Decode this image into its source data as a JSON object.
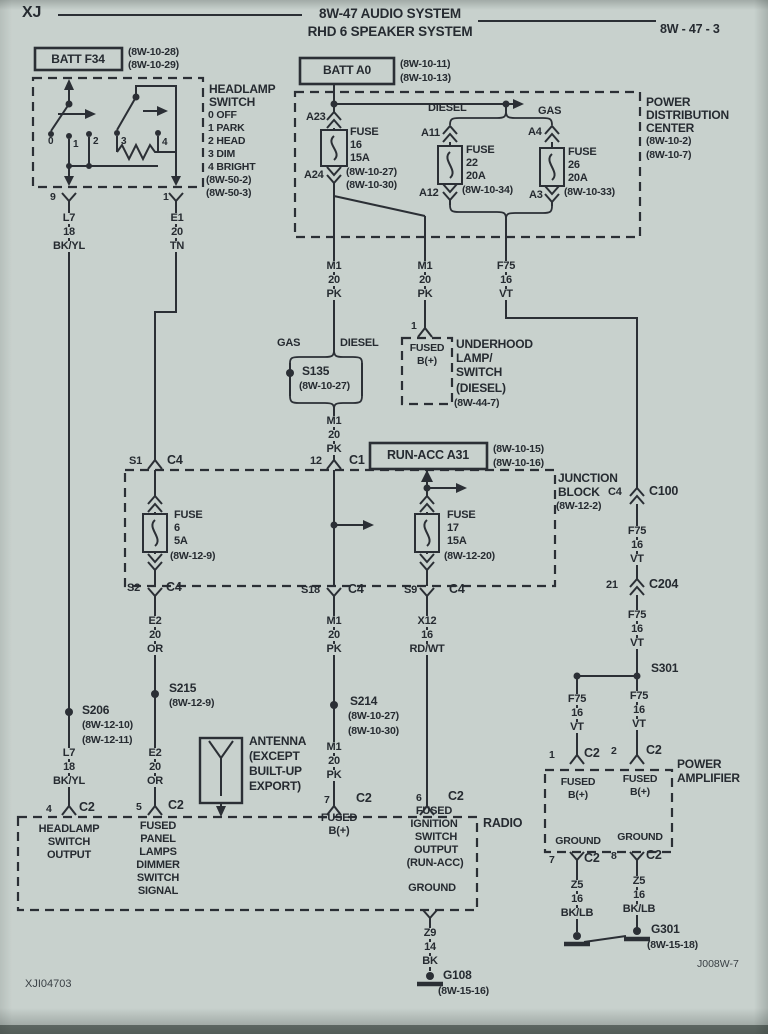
{
  "page": {
    "model": "XJ",
    "title1": "8W-47 AUDIO SYSTEM",
    "title2": "RHD 6 SPEAKER SYSTEM",
    "page_ref": "8W - 47 - 3",
    "footer_left": "XJI04703",
    "footer_right": "J008W-7"
  },
  "colors": {
    "paper": "#c8d1cd",
    "ink": "#2b2f35"
  },
  "labels": [
    {
      "t": "BATT F34",
      "x": 78,
      "y": 53,
      "a": "c",
      "s": 12
    },
    {
      "t": "(8W-10-28)",
      "x": 128,
      "y": 47,
      "s": 10.5
    },
    {
      "t": "(8W-10-29)",
      "x": 128,
      "y": 60,
      "s": 10.5
    },
    {
      "t": "HEADLAMP",
      "x": 209,
      "y": 83,
      "s": 12
    },
    {
      "t": "SWITCH",
      "x": 209,
      "y": 96,
      "s": 12
    },
    {
      "t": "0 OFF",
      "x": 208,
      "y": 110,
      "s": 10.5
    },
    {
      "t": "1 PARK",
      "x": 208,
      "y": 123,
      "s": 10.5
    },
    {
      "t": "2 HEAD",
      "x": 208,
      "y": 136,
      "s": 10.5
    },
    {
      "t": "3 DIM",
      "x": 208,
      "y": 149,
      "s": 10.5
    },
    {
      "t": "4 BRIGHT",
      "x": 208,
      "y": 162,
      "s": 10.5
    },
    {
      "t": "(8W-50-2)",
      "x": 206,
      "y": 175,
      "s": 10.5
    },
    {
      "t": "(8W-50-3)",
      "x": 206,
      "y": 188,
      "s": 10.5
    },
    {
      "t": "0",
      "x": 48,
      "y": 137,
      "s": 10
    },
    {
      "t": "1",
      "x": 73,
      "y": 140,
      "s": 10
    },
    {
      "t": "2",
      "x": 93,
      "y": 137,
      "s": 10
    },
    {
      "t": "3",
      "x": 121,
      "y": 137,
      "s": 10
    },
    {
      "t": "4",
      "x": 162,
      "y": 138,
      "s": 10
    },
    {
      "t": "9",
      "x": 50,
      "y": 192,
      "s": 10.5
    },
    {
      "t": "1",
      "x": 163,
      "y": 192,
      "s": 10.5
    },
    {
      "t": "L7",
      "x": 69,
      "y": 213,
      "a": "c",
      "m": 1
    },
    {
      "t": "18",
      "x": 69,
      "y": 227,
      "a": "c",
      "m": 1
    },
    {
      "t": "BK/YL",
      "x": 69,
      "y": 241,
      "a": "c",
      "m": 1
    },
    {
      "t": "E1",
      "x": 177,
      "y": 213,
      "a": "c",
      "m": 1
    },
    {
      "t": "20",
      "x": 177,
      "y": 227,
      "a": "c",
      "m": 1
    },
    {
      "t": "TN",
      "x": 177,
      "y": 241,
      "a": "c",
      "m": 1
    },
    {
      "t": "BATT A0",
      "x": 347,
      "y": 64,
      "a": "c",
      "s": 12
    },
    {
      "t": "(8W-10-11)",
      "x": 400,
      "y": 59,
      "s": 10.5
    },
    {
      "t": "(8W-10-13)",
      "x": 400,
      "y": 73,
      "s": 10.5
    },
    {
      "t": "POWER",
      "x": 646,
      "y": 96,
      "s": 12
    },
    {
      "t": "DISTRIBUTION",
      "x": 646,
      "y": 109,
      "s": 12
    },
    {
      "t": "CENTER",
      "x": 646,
      "y": 122,
      "s": 12
    },
    {
      "t": "(8W-10-2)",
      "x": 646,
      "y": 136,
      "s": 10.5
    },
    {
      "t": "(8W-10-7)",
      "x": 646,
      "y": 150,
      "s": 10.5
    },
    {
      "t": "DIESEL",
      "x": 428,
      "y": 103
    },
    {
      "t": "GAS",
      "x": 538,
      "y": 106
    },
    {
      "t": "A23",
      "x": 306,
      "y": 112
    },
    {
      "t": "A24",
      "x": 304,
      "y": 170
    },
    {
      "t": "FUSE",
      "x": 350,
      "y": 127
    },
    {
      "t": "16",
      "x": 350,
      "y": 140
    },
    {
      "t": "15A",
      "x": 350,
      "y": 153
    },
    {
      "t": "(8W-10-27)",
      "x": 346,
      "y": 167,
      "s": 10.5
    },
    {
      "t": "(8W-10-30)",
      "x": 346,
      "y": 180,
      "s": 10.5
    },
    {
      "t": "A11",
      "x": 421,
      "y": 128
    },
    {
      "t": "A12",
      "x": 419,
      "y": 188
    },
    {
      "t": "FUSE",
      "x": 466,
      "y": 145
    },
    {
      "t": "22",
      "x": 466,
      "y": 158
    },
    {
      "t": "20A",
      "x": 466,
      "y": 171
    },
    {
      "t": "(8W-10-34)",
      "x": 462,
      "y": 185,
      "s": 10.5
    },
    {
      "t": "A4",
      "x": 528,
      "y": 127
    },
    {
      "t": "A3",
      "x": 529,
      "y": 190
    },
    {
      "t": "FUSE",
      "x": 568,
      "y": 147
    },
    {
      "t": "26",
      "x": 568,
      "y": 160
    },
    {
      "t": "20A",
      "x": 568,
      "y": 173
    },
    {
      "t": "(8W-10-33)",
      "x": 564,
      "y": 187,
      "s": 10.5
    },
    {
      "t": "M1",
      "x": 334,
      "y": 261,
      "a": "c",
      "m": 1
    },
    {
      "t": "20",
      "x": 334,
      "y": 275,
      "a": "c",
      "m": 1
    },
    {
      "t": "PK",
      "x": 334,
      "y": 289,
      "a": "c",
      "m": 1
    },
    {
      "t": "M1",
      "x": 425,
      "y": 261,
      "a": "c",
      "m": 1
    },
    {
      "t": "20",
      "x": 425,
      "y": 275,
      "a": "c",
      "m": 1
    },
    {
      "t": "PK",
      "x": 425,
      "y": 289,
      "a": "c",
      "m": 1
    },
    {
      "t": "F75",
      "x": 506,
      "y": 261,
      "a": "c",
      "m": 1
    },
    {
      "t": "16",
      "x": 506,
      "y": 275,
      "a": "c",
      "m": 1
    },
    {
      "t": "VT",
      "x": 506,
      "y": 289,
      "a": "c",
      "m": 1
    },
    {
      "t": "1",
      "x": 411,
      "y": 321,
      "s": 10.5
    },
    {
      "t": "GAS",
      "x": 277,
      "y": 338
    },
    {
      "t": "DIESEL",
      "x": 340,
      "y": 338
    },
    {
      "t": "S135",
      "x": 302,
      "y": 365,
      "s": 12
    },
    {
      "t": "(8W-10-27)",
      "x": 299,
      "y": 381,
      "s": 10.5
    },
    {
      "t": "M1",
      "x": 334,
      "y": 416,
      "a": "c",
      "m": 1
    },
    {
      "t": "20",
      "x": 334,
      "y": 430,
      "a": "c",
      "m": 1
    },
    {
      "t": "PK",
      "x": 334,
      "y": 444,
      "a": "c",
      "m": 1
    },
    {
      "t": "FUSED",
      "x": 427,
      "y": 343,
      "a": "c",
      "s": 10.5
    },
    {
      "t": "B(+)",
      "x": 427,
      "y": 356,
      "a": "c",
      "s": 10.5
    },
    {
      "t": "UNDERHOOD",
      "x": 456,
      "y": 338,
      "s": 12
    },
    {
      "t": "LAMP/",
      "x": 456,
      "y": 352,
      "s": 12
    },
    {
      "t": "SWITCH",
      "x": 456,
      "y": 366,
      "s": 12
    },
    {
      "t": "(DIESEL)",
      "x": 456,
      "y": 382,
      "s": 12
    },
    {
      "t": "(8W-44-7)",
      "x": 454,
      "y": 398,
      "s": 10.5
    },
    {
      "t": "RUN-ACC A31",
      "x": 428,
      "y": 449,
      "a": "c",
      "s": 12.5
    },
    {
      "t": "(8W-10-15)",
      "x": 493,
      "y": 444,
      "s": 10.5
    },
    {
      "t": "(8W-10-16)",
      "x": 493,
      "y": 458,
      "s": 10.5
    },
    {
      "t": "JUNCTION",
      "x": 558,
      "y": 472,
      "s": 12
    },
    {
      "t": "BLOCK",
      "x": 558,
      "y": 486,
      "s": 12
    },
    {
      "t": "(8W-12-2)",
      "x": 556,
      "y": 501,
      "s": 10.5
    },
    {
      "t": "S1",
      "x": 129,
      "y": 456
    },
    {
      "t": "C4",
      "x": 167,
      "y": 454,
      "s": 12.5
    },
    {
      "t": "12",
      "x": 310,
      "y": 456
    },
    {
      "t": "C1",
      "x": 349,
      "y": 454,
      "s": 12.5
    },
    {
      "t": "FUSE",
      "x": 174,
      "y": 510
    },
    {
      "t": "6",
      "x": 174,
      "y": 523
    },
    {
      "t": "5A",
      "x": 174,
      "y": 536
    },
    {
      "t": "(8W-12-9)",
      "x": 170,
      "y": 551,
      "s": 10.5
    },
    {
      "t": "FUSE",
      "x": 447,
      "y": 510
    },
    {
      "t": "17",
      "x": 447,
      "y": 523
    },
    {
      "t": "15A",
      "x": 447,
      "y": 536
    },
    {
      "t": "(8W-12-20)",
      "x": 444,
      "y": 551,
      "s": 10.5
    },
    {
      "t": "S2",
      "x": 127,
      "y": 583
    },
    {
      "t": "C4",
      "x": 166,
      "y": 581,
      "s": 12.5
    },
    {
      "t": "S18",
      "x": 301,
      "y": 585
    },
    {
      "t": "C4",
      "x": 348,
      "y": 583,
      "s": 12.5
    },
    {
      "t": "S9",
      "x": 404,
      "y": 585
    },
    {
      "t": "C4",
      "x": 449,
      "y": 583,
      "s": 12.5
    },
    {
      "t": "E2",
      "x": 155,
      "y": 616,
      "a": "c",
      "m": 1
    },
    {
      "t": "20",
      "x": 155,
      "y": 630,
      "a": "c",
      "m": 1
    },
    {
      "t": "OR",
      "x": 155,
      "y": 644,
      "a": "c",
      "m": 1
    },
    {
      "t": "S215",
      "x": 169,
      "y": 682,
      "s": 12
    },
    {
      "t": "(8W-12-9)",
      "x": 169,
      "y": 698,
      "s": 10.5
    },
    {
      "t": "E2",
      "x": 155,
      "y": 748,
      "a": "c",
      "m": 1
    },
    {
      "t": "20",
      "x": 155,
      "y": 762,
      "a": "c",
      "m": 1
    },
    {
      "t": "OR",
      "x": 155,
      "y": 776,
      "a": "c",
      "m": 1
    },
    {
      "t": "M1",
      "x": 334,
      "y": 616,
      "a": "c",
      "m": 1
    },
    {
      "t": "20",
      "x": 334,
      "y": 630,
      "a": "c",
      "m": 1
    },
    {
      "t": "PK",
      "x": 334,
      "y": 644,
      "a": "c",
      "m": 1
    },
    {
      "t": "S214",
      "x": 350,
      "y": 695,
      "s": 12
    },
    {
      "t": "(8W-10-27)",
      "x": 348,
      "y": 711,
      "s": 10.5
    },
    {
      "t": "(8W-10-30)",
      "x": 348,
      "y": 726,
      "s": 10.5
    },
    {
      "t": "M1",
      "x": 334,
      "y": 742,
      "a": "c",
      "m": 1
    },
    {
      "t": "20",
      "x": 334,
      "y": 756,
      "a": "c",
      "m": 1
    },
    {
      "t": "PK",
      "x": 334,
      "y": 770,
      "a": "c",
      "m": 1
    },
    {
      "t": "X12",
      "x": 427,
      "y": 616,
      "a": "c",
      "m": 1
    },
    {
      "t": "16",
      "x": 427,
      "y": 630,
      "a": "c",
      "m": 1
    },
    {
      "t": "RD/WT",
      "x": 427,
      "y": 644,
      "a": "c",
      "m": 1
    },
    {
      "t": "S206",
      "x": 82,
      "y": 704,
      "s": 12
    },
    {
      "t": "(8W-12-10)",
      "x": 82,
      "y": 720,
      "s": 10.5
    },
    {
      "t": "(8W-12-11)",
      "x": 82,
      "y": 735,
      "s": 10.5
    },
    {
      "t": "L7",
      "x": 69,
      "y": 748,
      "a": "c",
      "m": 1
    },
    {
      "t": "18",
      "x": 69,
      "y": 762,
      "a": "c",
      "m": 1
    },
    {
      "t": "BK/YL",
      "x": 69,
      "y": 776,
      "a": "c",
      "m": 1
    },
    {
      "t": "ANTENNA",
      "x": 249,
      "y": 735,
      "s": 12
    },
    {
      "t": "(EXCEPT",
      "x": 249,
      "y": 750,
      "s": 12
    },
    {
      "t": "BUILT-UP",
      "x": 249,
      "y": 765,
      "s": 12
    },
    {
      "t": "EXPORT)",
      "x": 249,
      "y": 780,
      "s": 12
    },
    {
      "t": "4",
      "x": 46,
      "y": 804,
      "s": 10.5
    },
    {
      "t": "C2",
      "x": 79,
      "y": 801,
      "s": 12.5
    },
    {
      "t": "5",
      "x": 136,
      "y": 802,
      "s": 10.5
    },
    {
      "t": "C2",
      "x": 168,
      "y": 799,
      "s": 12.5
    },
    {
      "t": "7",
      "x": 324,
      "y": 795,
      "s": 10.5
    },
    {
      "t": "C2",
      "x": 356,
      "y": 792,
      "s": 12.5
    },
    {
      "t": "6",
      "x": 416,
      "y": 793,
      "s": 10.5
    },
    {
      "t": "C2",
      "x": 448,
      "y": 790,
      "s": 12.5
    },
    {
      "t": "RADIO",
      "x": 483,
      "y": 817,
      "s": 12.5
    },
    {
      "t": "HEADLAMP",
      "x": 69,
      "y": 824,
      "a": "c"
    },
    {
      "t": "SWITCH",
      "x": 69,
      "y": 837,
      "a": "c"
    },
    {
      "t": "OUTPUT",
      "x": 69,
      "y": 850,
      "a": "c"
    },
    {
      "t": "FUSED",
      "x": 158,
      "y": 821,
      "a": "c"
    },
    {
      "t": "PANEL",
      "x": 158,
      "y": 834,
      "a": "c"
    },
    {
      "t": "LAMPS",
      "x": 158,
      "y": 847,
      "a": "c"
    },
    {
      "t": "DIMMER",
      "x": 158,
      "y": 860,
      "a": "c"
    },
    {
      "t": "SWITCH",
      "x": 158,
      "y": 873,
      "a": "c"
    },
    {
      "t": "SIGNAL",
      "x": 158,
      "y": 886,
      "a": "c"
    },
    {
      "t": "FUSED",
      "x": 339,
      "y": 813,
      "a": "c"
    },
    {
      "t": "B(+)",
      "x": 339,
      "y": 826,
      "a": "c"
    },
    {
      "t": "FUSED",
      "x": 434,
      "y": 806,
      "a": "c"
    },
    {
      "t": "IGNITION",
      "x": 434,
      "y": 819,
      "a": "c"
    },
    {
      "t": "SWITCH",
      "x": 436,
      "y": 832,
      "a": "c"
    },
    {
      "t": "OUTPUT",
      "x": 436,
      "y": 845,
      "a": "c"
    },
    {
      "t": "(RUN-ACC)",
      "x": 435,
      "y": 858,
      "a": "c"
    },
    {
      "t": "GROUND",
      "x": 432,
      "y": 883,
      "a": "c"
    },
    {
      "t": "Z9",
      "x": 430,
      "y": 928,
      "a": "c",
      "m": 1
    },
    {
      "t": "14",
      "x": 430,
      "y": 942,
      "a": "c",
      "m": 1
    },
    {
      "t": "BK",
      "x": 430,
      "y": 956,
      "a": "c",
      "m": 1
    },
    {
      "t": "G108",
      "x": 443,
      "y": 969,
      "s": 12
    },
    {
      "t": "(8W-15-16)",
      "x": 438,
      "y": 986,
      "s": 10.5
    },
    {
      "t": "C4",
      "x": 608,
      "y": 487
    },
    {
      "t": "C100",
      "x": 649,
      "y": 485,
      "s": 12.5
    },
    {
      "t": "F75",
      "x": 637,
      "y": 526,
      "a": "c",
      "m": 1
    },
    {
      "t": "16",
      "x": 637,
      "y": 540,
      "a": "c",
      "m": 1
    },
    {
      "t": "VT",
      "x": 637,
      "y": 554,
      "a": "c",
      "m": 1
    },
    {
      "t": "21",
      "x": 606,
      "y": 580
    },
    {
      "t": "C204",
      "x": 649,
      "y": 578,
      "s": 12.5
    },
    {
      "t": "F75",
      "x": 637,
      "y": 610,
      "a": "c",
      "m": 1
    },
    {
      "t": "16",
      "x": 637,
      "y": 624,
      "a": "c",
      "m": 1
    },
    {
      "t": "VT",
      "x": 637,
      "y": 638,
      "a": "c",
      "m": 1
    },
    {
      "t": "S301",
      "x": 651,
      "y": 662,
      "s": 12
    },
    {
      "t": "F75",
      "x": 577,
      "y": 694,
      "a": "c",
      "m": 1
    },
    {
      "t": "16",
      "x": 577,
      "y": 708,
      "a": "c",
      "m": 1
    },
    {
      "t": "VT",
      "x": 577,
      "y": 722,
      "a": "c",
      "m": 1
    },
    {
      "t": "F75",
      "x": 639,
      "y": 691,
      "a": "c",
      "m": 1
    },
    {
      "t": "16",
      "x": 639,
      "y": 705,
      "a": "c",
      "m": 1
    },
    {
      "t": "VT",
      "x": 639,
      "y": 719,
      "a": "c",
      "m": 1
    },
    {
      "t": "1",
      "x": 549,
      "y": 750,
      "s": 10.5
    },
    {
      "t": "C2",
      "x": 584,
      "y": 747,
      "s": 12.5
    },
    {
      "t": "2",
      "x": 611,
      "y": 746,
      "s": 10.5
    },
    {
      "t": "C2",
      "x": 646,
      "y": 744,
      "s": 12.5
    },
    {
      "t": "POWER",
      "x": 677,
      "y": 758,
      "s": 12
    },
    {
      "t": "AMPLIFIER",
      "x": 677,
      "y": 772,
      "s": 12
    },
    {
      "t": "FUSED",
      "x": 578,
      "y": 777,
      "a": "c",
      "s": 10.5
    },
    {
      "t": "B(+)",
      "x": 578,
      "y": 790,
      "a": "c",
      "s": 10.5
    },
    {
      "t": "FUSED",
      "x": 640,
      "y": 774,
      "a": "c",
      "s": 10.5
    },
    {
      "t": "B(+)",
      "x": 640,
      "y": 787,
      "a": "c",
      "s": 10.5
    },
    {
      "t": "GROUND",
      "x": 578,
      "y": 836,
      "a": "c",
      "s": 10.5
    },
    {
      "t": "GROUND",
      "x": 640,
      "y": 832,
      "a": "c",
      "s": 10.5
    },
    {
      "t": "7",
      "x": 549,
      "y": 855,
      "s": 10.5
    },
    {
      "t": "C2",
      "x": 584,
      "y": 852,
      "s": 12.5
    },
    {
      "t": "8",
      "x": 611,
      "y": 851,
      "s": 10.5
    },
    {
      "t": "C2",
      "x": 646,
      "y": 849,
      "s": 12.5
    },
    {
      "t": "Z5",
      "x": 577,
      "y": 880,
      "a": "c",
      "m": 1
    },
    {
      "t": "16",
      "x": 577,
      "y": 894,
      "a": "c",
      "m": 1
    },
    {
      "t": "BK/LB",
      "x": 577,
      "y": 908,
      "a": "c",
      "m": 1
    },
    {
      "t": "Z5",
      "x": 639,
      "y": 876,
      "a": "c",
      "m": 1
    },
    {
      "t": "16",
      "x": 639,
      "y": 890,
      "a": "c",
      "m": 1
    },
    {
      "t": "BK/LB",
      "x": 639,
      "y": 904,
      "a": "c",
      "m": 1
    },
    {
      "t": "G301",
      "x": 651,
      "y": 923,
      "s": 12
    },
    {
      "t": "(8W-15-18)",
      "x": 647,
      "y": 940,
      "s": 10.5
    }
  ]
}
